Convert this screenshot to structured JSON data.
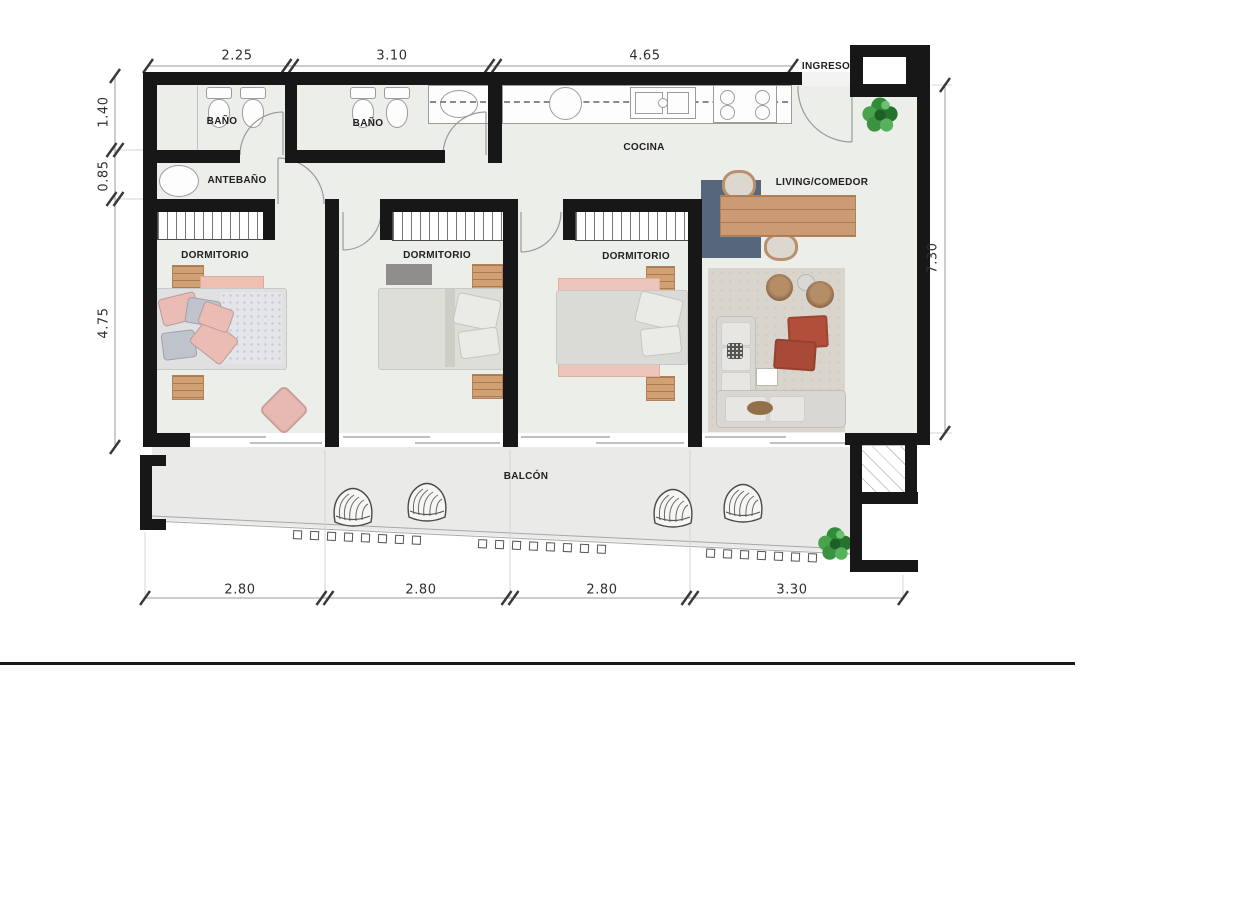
{
  "rooms": [
    {
      "id": "bathroom-1",
      "label": "BAÑO"
    },
    {
      "id": "bathroom-2",
      "label": "BAÑO"
    },
    {
      "id": "antebathroom",
      "label": "ANTEBAÑO"
    },
    {
      "id": "bedroom-1",
      "label": "DORMITORIO"
    },
    {
      "id": "bedroom-2",
      "label": "DORMITORIO"
    },
    {
      "id": "bedroom-3",
      "label": "DORMITORIO"
    },
    {
      "id": "kitchen",
      "label": "COCINA"
    },
    {
      "id": "living-dining",
      "label": "LIVING/COMEDOR"
    },
    {
      "id": "balcony",
      "label": "BALCÓN"
    },
    {
      "id": "entry",
      "label": "INGRESO"
    }
  ],
  "dimensions": {
    "top": [
      "2.25",
      "3.10",
      "4.65"
    ],
    "left": [
      "1.40",
      "0.85",
      "4.75"
    ],
    "right": [
      "7.30"
    ],
    "bottom": [
      "2.80",
      "2.80",
      "2.80",
      "3.30"
    ]
  },
  "colors": {
    "wall": "#171717",
    "floor": "#eceeea",
    "accent_wood": "#d2a173",
    "accent_red": "#b14f3b",
    "accent_blue": "#56677c",
    "plant_green": "#2f8c38"
  }
}
